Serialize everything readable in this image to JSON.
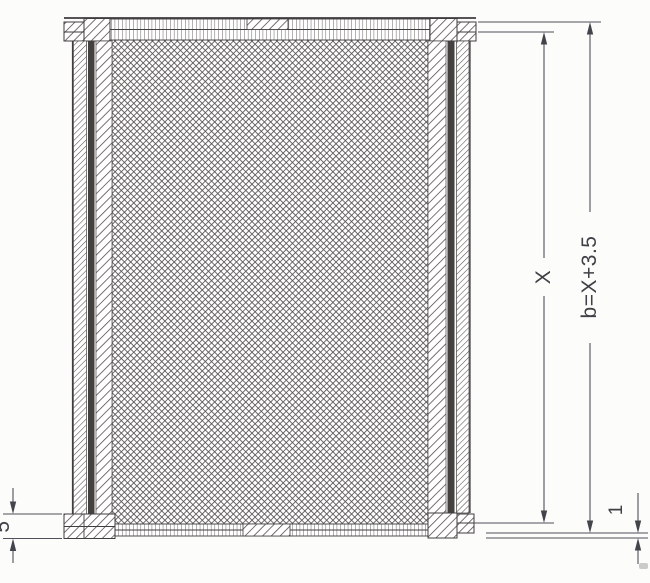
{
  "diagram": {
    "kind": "technical-section-drawing",
    "subject": "rectangular frame section with cross-hatched infill panel, hatched top/bottom/side bars and dimension lines",
    "dimension_labels": {
      "inner_height": "X",
      "outer_height": "b=X+3.5",
      "bottom_bar_thickness": "5",
      "bottom_step": "1"
    },
    "colors": {
      "background": "#fcfcfa",
      "line": "#3f3d3e",
      "hatch": "#56504e",
      "crosshatch": "#575150",
      "dark_strip": "#454140",
      "dimension_line": "#50515a",
      "label_text": "#3f4147"
    }
  }
}
